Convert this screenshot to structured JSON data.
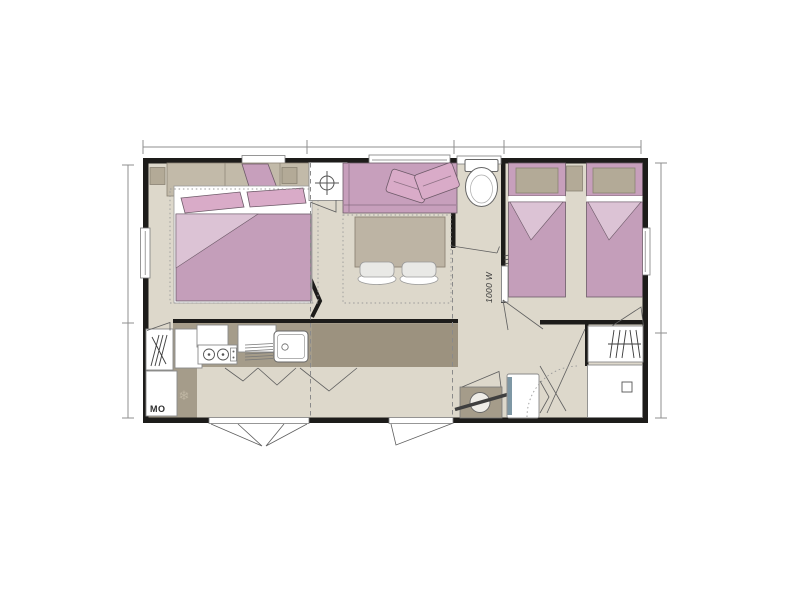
{
  "plan": {
    "labels": {
      "heater_wattage": "1000 W",
      "microwave": "MO"
    },
    "icons": {
      "snowflake": "❄"
    },
    "colors": {
      "wall": "#1d1c1a",
      "floor": "#ddd8cb",
      "mauve_bedding": "#c49eba",
      "mauve_sofa": "#c79fbc",
      "pink_cushion": "#d9abc8",
      "pink_fold": "#dcc3d5",
      "beige_furniture": "#c2baa9",
      "counter_taupe": "#a59c8a",
      "table_taupe": "#bdb4a4",
      "dimension_line": "#8f8f8f"
    }
  }
}
